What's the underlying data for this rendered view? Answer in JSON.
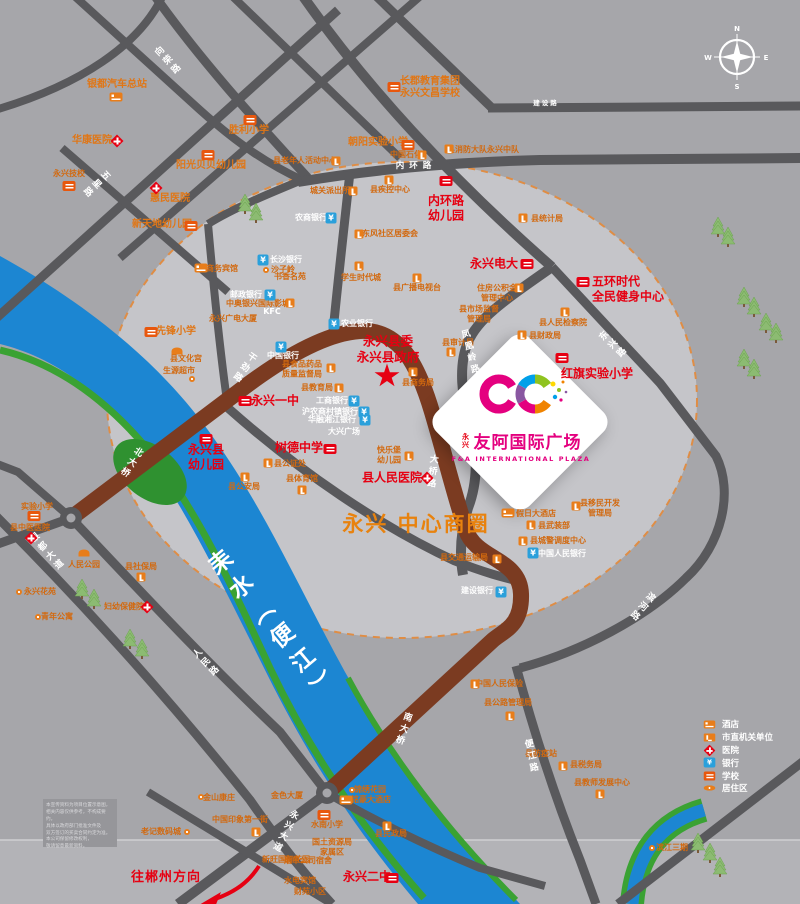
{
  "plaza": {
    "prefix": "永兴",
    "name_cn": "友阿国际广场",
    "name_en": "F&A INTERNATIONAL PLAZA",
    "brand_color": "#e4007f"
  },
  "government": {
    "text": "永兴县委\n永兴县政府"
  },
  "district": {
    "text": "永兴\n中心商圈",
    "color": "#e8820e"
  },
  "direction_note": {
    "text": "往郴州方向"
  },
  "compass": {
    "n": "N",
    "e": "E",
    "s": "S",
    "w": "W"
  },
  "legend": {
    "items": [
      {
        "icon": "hotel-icon",
        "label": "酒店"
      },
      {
        "icon": "government-icon",
        "label": "市直机关单位"
      },
      {
        "icon": "hospital-icon",
        "label": "医院"
      },
      {
        "icon": "bank-icon",
        "label": "银行"
      },
      {
        "icon": "school-icon",
        "label": "学校"
      },
      {
        "icon": "residence-icon",
        "label": "居住区"
      }
    ]
  },
  "disclaimer": {
    "lines": [
      "本宣传资料为项目位置示意图，",
      "相关内容仅供参考，不构成要约。",
      "具体以政府部门批准文件及",
      "双方签订的买卖合同约定为准。",
      "本公司保留修改权利，",
      "敬请留意最新资料。"
    ]
  },
  "map": {
    "colors": {
      "background": "#a6a6aa",
      "highlight_circle": "#c5c5c9",
      "circle_dash": "#df8d45",
      "road": "#59595c",
      "main_road_brown": "#7b3b21",
      "river_blue": "#1c86d2",
      "bank_green": "#3aa233",
      "poi_red": "#e60012",
      "poi_orange": "#d2690f"
    },
    "labels": [
      {
        "text": "银都汽车总站",
        "x": 117,
        "y": 85,
        "cls": "o2"
      },
      {
        "text": "华康医院",
        "x": 92,
        "y": 141,
        "cls": "o2"
      },
      {
        "text": "胜利小学",
        "x": 249,
        "y": 131,
        "cls": "o2"
      },
      {
        "text": "阳光贝贝幼儿园",
        "x": 211,
        "y": 166,
        "cls": "o2"
      },
      {
        "text": "永兴技校",
        "x": 69,
        "y": 174,
        "cls": "o"
      },
      {
        "text": "惠民医院",
        "x": 170,
        "y": 199,
        "cls": "o2"
      },
      {
        "text": "新天地幼儿园",
        "x": 162,
        "y": 225,
        "cls": "o2"
      },
      {
        "text": "长郡教育集团\n永兴文昌学校",
        "x": 430,
        "y": 88,
        "cls": "o2"
      },
      {
        "text": "朝阳实验小学",
        "x": 378,
        "y": 143,
        "cls": "o2"
      },
      {
        "text": "县消防大队永兴中队",
        "x": 483,
        "y": 150,
        "cls": "o"
      },
      {
        "text": "中国石化",
        "x": 406,
        "y": 155,
        "cls": "o"
      },
      {
        "text": "县老年人活动中心",
        "x": 305,
        "y": 161,
        "cls": "o"
      },
      {
        "text": "城关派出所",
        "x": 330,
        "y": 191,
        "cls": "o"
      },
      {
        "text": "县疾控中心",
        "x": 390,
        "y": 190,
        "cls": "o"
      },
      {
        "text": "内环路\n幼儿园",
        "x": 446,
        "y": 208,
        "cls": "r",
        "name": "label-neihuanlu-kindergarten"
      },
      {
        "text": "县统计局",
        "x": 547,
        "y": 219,
        "cls": "o"
      },
      {
        "text": "农商银行",
        "x": 311,
        "y": 218,
        "cls": "w"
      },
      {
        "text": "东风社区居委会",
        "x": 390,
        "y": 234,
        "cls": "o"
      },
      {
        "text": "学生时代城",
        "x": 361,
        "y": 278,
        "cls": "o"
      },
      {
        "text": "县广播电视台",
        "x": 417,
        "y": 288,
        "cls": "o"
      },
      {
        "text": "永兴电大",
        "x": 494,
        "y": 264,
        "cls": "r",
        "name": "label-yongxing-tvu"
      },
      {
        "text": "住房公积金\n管理中心",
        "x": 497,
        "y": 293,
        "cls": "o"
      },
      {
        "text": "五环时代\n全民健身中心",
        "x": 592,
        "y": 289,
        "cls": "r left",
        "name": "label-wuhuan-fitness"
      },
      {
        "text": "县市场监督\n管理局",
        "x": 479,
        "y": 314,
        "cls": "o"
      },
      {
        "text": "县人民检察院",
        "x": 563,
        "y": 323,
        "cls": "o"
      },
      {
        "text": "县财政局",
        "x": 545,
        "y": 336,
        "cls": "o"
      },
      {
        "text": "县审计局",
        "x": 458,
        "y": 343,
        "cls": "o"
      },
      {
        "text": "红旗实验小学",
        "x": 597,
        "y": 374,
        "cls": "r",
        "name": "label-hongqi-primary"
      },
      {
        "text": "长沙银行",
        "x": 286,
        "y": 260,
        "cls": "w"
      },
      {
        "text": "商务宾馆",
        "x": 222,
        "y": 269,
        "cls": "o"
      },
      {
        "text": "沙子岭",
        "x": 283,
        "y": 270,
        "cls": "o"
      },
      {
        "text": "书香名苑",
        "x": 290,
        "y": 277,
        "cls": "o"
      },
      {
        "text": "邮政银行",
        "x": 246,
        "y": 295,
        "cls": "w"
      },
      {
        "text": "中奥银兴国际影城",
        "x": 258,
        "y": 304,
        "cls": "o"
      },
      {
        "text": "KFC",
        "x": 272,
        "y": 312,
        "cls": "w"
      },
      {
        "text": "永兴广电大厦",
        "x": 233,
        "y": 319,
        "cls": "o"
      },
      {
        "text": "农业银行",
        "x": 357,
        "y": 324,
        "cls": "w"
      },
      {
        "text": "县商务局",
        "x": 418,
        "y": 383,
        "cls": "o"
      },
      {
        "text": "先锋小学",
        "x": 176,
        "y": 332,
        "cls": "o2"
      },
      {
        "text": "县文化宫",
        "x": 186,
        "y": 359,
        "cls": "o"
      },
      {
        "text": "生源超市",
        "x": 179,
        "y": 371,
        "cls": "o"
      },
      {
        "text": "中国银行",
        "x": 283,
        "y": 356,
        "cls": "w"
      },
      {
        "text": "县食品药品\n质量监督局",
        "x": 302,
        "y": 369,
        "cls": "o"
      },
      {
        "text": "县教育局",
        "x": 317,
        "y": 388,
        "cls": "o"
      },
      {
        "text": "工商银行",
        "x": 332,
        "y": 401,
        "cls": "w"
      },
      {
        "text": "沪农商村镇银行",
        "x": 330,
        "y": 412,
        "cls": "w"
      },
      {
        "text": "华融湘江银行",
        "x": 332,
        "y": 420,
        "cls": "w"
      },
      {
        "text": "大兴广场",
        "x": 344,
        "y": 432,
        "cls": "w"
      },
      {
        "text": "永兴一中",
        "x": 275,
        "y": 401,
        "cls": "r",
        "name": "label-yongxing-no1-middle"
      },
      {
        "text": "树德中学",
        "x": 299,
        "y": 448,
        "cls": "r",
        "name": "label-shude-middle"
      },
      {
        "text": "永兴县\n幼儿园",
        "x": 206,
        "y": 457,
        "cls": "r",
        "name": "label-county-kindergarten"
      },
      {
        "text": "快乐堡\n幼儿园",
        "x": 389,
        "y": 455,
        "cls": "o"
      },
      {
        "text": "县公证处",
        "x": 290,
        "y": 464,
        "cls": "o"
      },
      {
        "text": "县公安局",
        "x": 244,
        "y": 487,
        "cls": "o"
      },
      {
        "text": "县体育馆",
        "x": 302,
        "y": 479,
        "cls": "o"
      },
      {
        "text": "县人民医院",
        "x": 392,
        "y": 478,
        "cls": "r",
        "name": "label-county-hospital"
      },
      {
        "text": "人民公园",
        "x": 84,
        "y": 565,
        "cls": "o"
      },
      {
        "text": "实验小学",
        "x": 37,
        "y": 507,
        "cls": "o"
      },
      {
        "text": "县中医医院",
        "x": 30,
        "y": 528,
        "cls": "o"
      },
      {
        "text": "县社保局",
        "x": 141,
        "y": 567,
        "cls": "o"
      },
      {
        "text": "妇幼保健院",
        "x": 124,
        "y": 607,
        "cls": "o"
      },
      {
        "text": "永兴花苑",
        "x": 40,
        "y": 592,
        "cls": "o"
      },
      {
        "text": "青年公寓",
        "x": 57,
        "y": 617,
        "cls": "o"
      },
      {
        "text": "假日大酒店",
        "x": 536,
        "y": 514,
        "cls": "o"
      },
      {
        "text": "县武装部",
        "x": 554,
        "y": 526,
        "cls": "o"
      },
      {
        "text": "县城警调度中心",
        "x": 558,
        "y": 541,
        "cls": "o"
      },
      {
        "text": "中国人民银行",
        "x": 562,
        "y": 554,
        "cls": "w"
      },
      {
        "text": "县移民开发\n管理局",
        "x": 600,
        "y": 508,
        "cls": "o"
      },
      {
        "text": "县交通运输局",
        "x": 464,
        "y": 558,
        "cls": "o"
      },
      {
        "text": "建设银行",
        "x": 477,
        "y": 591,
        "cls": "w"
      },
      {
        "text": "县公路管理局",
        "x": 508,
        "y": 703,
        "cls": "o"
      },
      {
        "text": "中国人民保险",
        "x": 499,
        "y": 684,
        "cls": "o"
      },
      {
        "text": "锦绣花园",
        "x": 370,
        "y": 790,
        "cls": "o"
      },
      {
        "text": "铭豪大酒店",
        "x": 371,
        "y": 800,
        "cls": "o"
      },
      {
        "text": "水南小学",
        "x": 327,
        "y": 825,
        "cls": "o"
      },
      {
        "text": "县民政局",
        "x": 391,
        "y": 834,
        "cls": "o"
      },
      {
        "text": "国土资源局\n家属区",
        "x": 332,
        "y": 847,
        "cls": "o"
      },
      {
        "text": "烟草公司宿舍",
        "x": 308,
        "y": 861,
        "cls": "o"
      },
      {
        "text": "水电宾馆",
        "x": 300,
        "y": 881,
        "cls": "o"
      },
      {
        "text": "财苑小区",
        "x": 310,
        "y": 892,
        "cls": "o"
      },
      {
        "text": "永兴二中",
        "x": 367,
        "y": 877,
        "cls": "r",
        "name": "label-yongxing-no2-middle"
      },
      {
        "text": "老记数码城",
        "x": 161,
        "y": 832,
        "cls": "o"
      },
      {
        "text": "金山康庄",
        "x": 219,
        "y": 798,
        "cls": "o"
      },
      {
        "text": "中国印象第一街",
        "x": 240,
        "y": 820,
        "cls": "o"
      },
      {
        "text": "金色大厦",
        "x": 287,
        "y": 796,
        "cls": "o"
      },
      {
        "text": "新旺国际花园",
        "x": 286,
        "y": 860,
        "cls": "o"
      },
      {
        "text": "县税务局",
        "x": 586,
        "y": 765,
        "cls": "o"
      },
      {
        "text": "县教师发展中心",
        "x": 602,
        "y": 783,
        "cls": "o"
      },
      {
        "text": "县防疫站",
        "x": 541,
        "y": 754,
        "cls": "o"
      },
      {
        "text": "滨江三期",
        "x": 672,
        "y": 848,
        "cls": "o"
      },
      {
        "text": "向荣路",
        "x": 167,
        "y": 62,
        "cls": "rd vert",
        "rot": -43,
        "name": "road-label"
      },
      {
        "text": "五星路",
        "x": 95,
        "y": 183,
        "cls": "rd vert",
        "rot": 47,
        "name": "road-label"
      },
      {
        "text": "建设路",
        "x": 546,
        "y": 104,
        "cls": "h",
        "name": "road-label"
      },
      {
        "text": "内环路",
        "x": 416,
        "y": 166,
        "cls": "h2",
        "name": "road-label"
      },
      {
        "text": "干劲路",
        "x": 243,
        "y": 367,
        "cls": "rd vert",
        "rot": 35,
        "name": "road-label"
      },
      {
        "text": "北大桥",
        "x": 130,
        "y": 462,
        "cls": "rd vert",
        "rot": 33,
        "name": "bridge-label"
      },
      {
        "text": "大桥路",
        "x": 431,
        "y": 472,
        "cls": "rd vert",
        "rot": 6,
        "name": "road-label"
      },
      {
        "text": "南大桥",
        "x": 402,
        "y": 729,
        "cls": "rd vert",
        "rot": 18,
        "name": "bridge-label"
      },
      {
        "text": "永兴大道",
        "x": 284,
        "y": 831,
        "cls": "rd vert",
        "rot": 27,
        "name": "road-label"
      },
      {
        "text": "人民路",
        "x": 205,
        "y": 664,
        "cls": "rd vert",
        "rot": -44,
        "name": "road-label"
      },
      {
        "text": "银都大道",
        "x": 46,
        "y": 553,
        "cls": "rd vert",
        "rot": -42,
        "name": "road-label"
      },
      {
        "text": "凤凰岭路",
        "x": 469,
        "y": 353,
        "cls": "rd vert",
        "rot": -15,
        "name": "road-label"
      },
      {
        "text": "东兴路",
        "x": 612,
        "y": 346,
        "cls": "rd vert",
        "rot": -47,
        "name": "road-label"
      },
      {
        "text": "滨河路",
        "x": 641,
        "y": 606,
        "cls": "rd vert",
        "rot": 40,
        "name": "road-label"
      },
      {
        "text": "便江路",
        "x": 530,
        "y": 757,
        "cls": "rd vert",
        "rot": -12,
        "name": "road-label"
      },
      {
        "text": "耒水（便江）",
        "x": 272,
        "y": 628,
        "cls": "riv vert",
        "rot": -40,
        "name": "river-name"
      }
    ],
    "icons": [
      {
        "t": "hotel",
        "x": 116,
        "y": 97
      },
      {
        "t": "hosp",
        "x": 117,
        "y": 141
      },
      {
        "t": "sch",
        "x": 250,
        "y": 120
      },
      {
        "t": "sch",
        "x": 208,
        "y": 155
      },
      {
        "t": "sch",
        "x": 69,
        "y": 186
      },
      {
        "t": "hosp",
        "x": 156,
        "y": 188
      },
      {
        "t": "sch",
        "x": 191,
        "y": 226
      },
      {
        "t": "sch",
        "x": 394,
        "y": 87
      },
      {
        "t": "sch",
        "x": 408,
        "y": 145
      },
      {
        "t": "govt",
        "x": 449,
        "y": 149
      },
      {
        "t": "govt",
        "x": 422,
        "y": 155
      },
      {
        "t": "govt",
        "x": 336,
        "y": 161
      },
      {
        "t": "govt",
        "x": 353,
        "y": 191
      },
      {
        "t": "govt",
        "x": 389,
        "y": 180
      },
      {
        "t": "schr",
        "x": 446,
        "y": 181
      },
      {
        "t": "govt",
        "x": 523,
        "y": 218
      },
      {
        "t": "bank",
        "x": 331,
        "y": 218
      },
      {
        "t": "govt",
        "x": 359,
        "y": 234
      },
      {
        "t": "govt",
        "x": 359,
        "y": 266
      },
      {
        "t": "govt",
        "x": 417,
        "y": 278
      },
      {
        "t": "schr",
        "x": 527,
        "y": 264
      },
      {
        "t": "govt",
        "x": 519,
        "y": 288
      },
      {
        "t": "schr",
        "x": 583,
        "y": 282
      },
      {
        "t": "govt",
        "x": 565,
        "y": 312
      },
      {
        "t": "govt",
        "x": 522,
        "y": 335
      },
      {
        "t": "govt",
        "x": 451,
        "y": 352
      },
      {
        "t": "govt",
        "x": 413,
        "y": 372
      },
      {
        "t": "schr",
        "x": 562,
        "y": 358
      },
      {
        "t": "bank",
        "x": 263,
        "y": 260
      },
      {
        "t": "hotel",
        "x": 201,
        "y": 268
      },
      {
        "t": "bank",
        "x": 270,
        "y": 295
      },
      {
        "t": "govt",
        "x": 290,
        "y": 303
      },
      {
        "t": "bank",
        "x": 334,
        "y": 324
      },
      {
        "t": "bank",
        "x": 281,
        "y": 347
      },
      {
        "t": "sch",
        "x": 151,
        "y": 332
      },
      {
        "t": "park",
        "x": 177,
        "y": 351
      },
      {
        "t": "dot",
        "x": 192,
        "y": 379
      },
      {
        "t": "govt",
        "x": 331,
        "y": 368
      },
      {
        "t": "govt",
        "x": 339,
        "y": 388
      },
      {
        "t": "bank",
        "x": 354,
        "y": 401
      },
      {
        "t": "bank",
        "x": 364,
        "y": 412
      },
      {
        "t": "bank",
        "x": 365,
        "y": 420
      },
      {
        "t": "schr",
        "x": 245,
        "y": 401
      },
      {
        "t": "schr",
        "x": 330,
        "y": 449
      },
      {
        "t": "schr",
        "x": 206,
        "y": 439
      },
      {
        "t": "govt",
        "x": 409,
        "y": 456
      },
      {
        "t": "govt",
        "x": 268,
        "y": 463
      },
      {
        "t": "govt",
        "x": 245,
        "y": 477
      },
      {
        "t": "govt",
        "x": 302,
        "y": 490
      },
      {
        "t": "hosp",
        "x": 427,
        "y": 478
      },
      {
        "t": "park",
        "x": 84,
        "y": 553
      },
      {
        "t": "sch",
        "x": 34,
        "y": 516
      },
      {
        "t": "hosp",
        "x": 31,
        "y": 538
      },
      {
        "t": "govt",
        "x": 141,
        "y": 577
      },
      {
        "t": "hosp",
        "x": 147,
        "y": 607
      },
      {
        "t": "dot",
        "x": 19,
        "y": 592
      },
      {
        "t": "dot",
        "x": 38,
        "y": 617
      },
      {
        "t": "hotel",
        "x": 508,
        "y": 513
      },
      {
        "t": "govt",
        "x": 531,
        "y": 525
      },
      {
        "t": "govt",
        "x": 523,
        "y": 541
      },
      {
        "t": "bank",
        "x": 533,
        "y": 553
      },
      {
        "t": "govt",
        "x": 576,
        "y": 506
      },
      {
        "t": "govt",
        "x": 497,
        "y": 559
      },
      {
        "t": "bank",
        "x": 501,
        "y": 592
      },
      {
        "t": "govt",
        "x": 475,
        "y": 684
      },
      {
        "t": "govt",
        "x": 510,
        "y": 716
      },
      {
        "t": "dot",
        "x": 352,
        "y": 790
      },
      {
        "t": "hotel",
        "x": 346,
        "y": 800
      },
      {
        "t": "sch",
        "x": 324,
        "y": 815
      },
      {
        "t": "govt",
        "x": 387,
        "y": 826
      },
      {
        "t": "schr",
        "x": 392,
        "y": 878
      },
      {
        "t": "dot",
        "x": 187,
        "y": 832
      },
      {
        "t": "dot",
        "x": 201,
        "y": 797
      },
      {
        "t": "govt",
        "x": 256,
        "y": 832
      },
      {
        "t": "govt",
        "x": 563,
        "y": 766
      },
      {
        "t": "govt",
        "x": 600,
        "y": 794
      },
      {
        "t": "dot",
        "x": 652,
        "y": 848
      },
      {
        "t": "dot",
        "x": 266,
        "y": 270
      }
    ]
  }
}
